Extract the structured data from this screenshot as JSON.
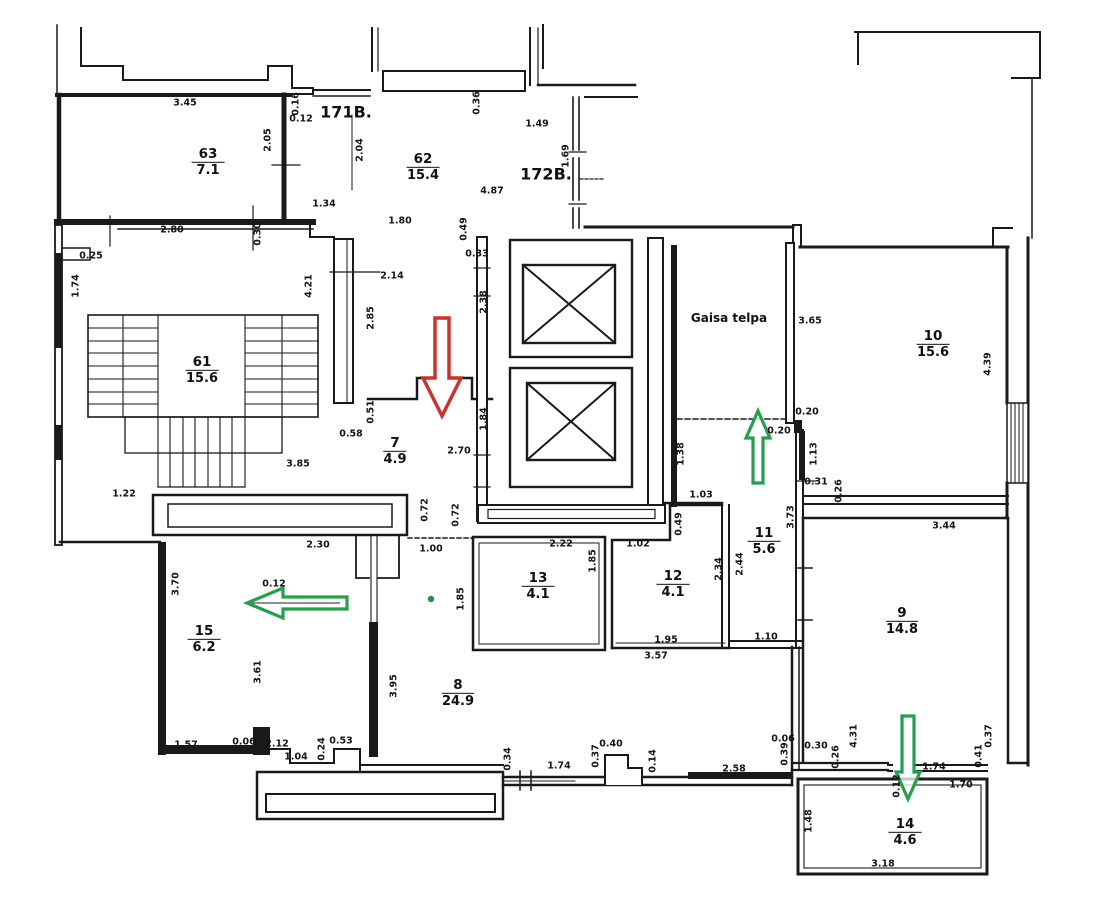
{
  "plan": {
    "colors": {
      "wall": "#1a1a1a",
      "red_arrow": "#d03026",
      "green_arrow": "#22a14b",
      "green_dot": "#2e8b4a"
    },
    "rooms": [
      {
        "number": "63",
        "area": "7.1",
        "x": 208,
        "y": 163
      },
      {
        "number": "62",
        "area": "15.4",
        "x": 423,
        "y": 168
      },
      {
        "number": "61",
        "area": "15.6",
        "x": 202,
        "y": 371
      },
      {
        "number": "7",
        "area": "4.9",
        "x": 395,
        "y": 452
      },
      {
        "number": "10",
        "area": "15.6",
        "x": 933,
        "y": 345
      },
      {
        "number": "11",
        "area": "5.6",
        "x": 764,
        "y": 542
      },
      {
        "number": "13",
        "area": "4.1",
        "x": 538,
        "y": 587
      },
      {
        "number": "12",
        "area": "4.1",
        "x": 673,
        "y": 585
      },
      {
        "number": "9",
        "area": "14.8",
        "x": 902,
        "y": 622
      },
      {
        "number": "15",
        "area": "6.2",
        "x": 204,
        "y": 640
      },
      {
        "number": "8",
        "area": "24.9",
        "x": 458,
        "y": 694
      },
      {
        "number": "14",
        "area": "4.6",
        "x": 905,
        "y": 833
      }
    ],
    "texts": [
      {
        "t": "171B.",
        "x": 346,
        "y": 112,
        "size": 16
      },
      {
        "t": "172B.",
        "x": 546,
        "y": 174,
        "size": 16
      },
      {
        "t": "Gaisa  telpa",
        "x": 729,
        "y": 318,
        "size": 12
      }
    ],
    "dims": [
      {
        "t": "3.45",
        "x": 185,
        "y": 103,
        "r": "h"
      },
      {
        "t": "2.05",
        "x": 268,
        "y": 140,
        "r": "v"
      },
      {
        "t": "0.16",
        "x": 296,
        "y": 104,
        "r": "v"
      },
      {
        "t": "0.12",
        "x": 301,
        "y": 119,
        "r": "h"
      },
      {
        "t": "2.04",
        "x": 360,
        "y": 150,
        "r": "v"
      },
      {
        "t": "0.36",
        "x": 477,
        "y": 103,
        "r": "v"
      },
      {
        "t": "1.49",
        "x": 537,
        "y": 124,
        "r": "h"
      },
      {
        "t": "1.69",
        "x": 566,
        "y": 156,
        "r": "v"
      },
      {
        "t": "4.87",
        "x": 492,
        "y": 191,
        "r": "h"
      },
      {
        "t": "1.80",
        "x": 400,
        "y": 221,
        "r": "h"
      },
      {
        "t": "1.34",
        "x": 324,
        "y": 204,
        "r": "h"
      },
      {
        "t": "2.80",
        "x": 172,
        "y": 230,
        "r": "h"
      },
      {
        "t": "0.30",
        "x": 258,
        "y": 234,
        "r": "v"
      },
      {
        "t": "0.25",
        "x": 91,
        "y": 256,
        "r": "h"
      },
      {
        "t": "1.74",
        "x": 76,
        "y": 286,
        "r": "v"
      },
      {
        "t": "4.21",
        "x": 309,
        "y": 286,
        "r": "v"
      },
      {
        "t": "2.14",
        "x": 392,
        "y": 276,
        "r": "h"
      },
      {
        "t": "2.85",
        "x": 371,
        "y": 318,
        "r": "v"
      },
      {
        "t": "0.49",
        "x": 464,
        "y": 229,
        "r": "v"
      },
      {
        "t": "0.33",
        "x": 477,
        "y": 254,
        "r": "h"
      },
      {
        "t": "2.38",
        "x": 484,
        "y": 302,
        "r": "v"
      },
      {
        "t": "3.85",
        "x": 298,
        "y": 464,
        "r": "h"
      },
      {
        "t": "1.22",
        "x": 124,
        "y": 494,
        "r": "h"
      },
      {
        "t": "0.51",
        "x": 371,
        "y": 412,
        "r": "v"
      },
      {
        "t": "0.58",
        "x": 351,
        "y": 434,
        "r": "h"
      },
      {
        "t": "1.84",
        "x": 484,
        "y": 419,
        "r": "v"
      },
      {
        "t": "2.70",
        "x": 459,
        "y": 451,
        "r": "h"
      },
      {
        "t": "3.65",
        "x": 810,
        "y": 321,
        "r": "h"
      },
      {
        "t": "0.20",
        "x": 807,
        "y": 412,
        "r": "h"
      },
      {
        "t": "0.20",
        "x": 779,
        "y": 431,
        "r": "h"
      },
      {
        "t": "1.38",
        "x": 681,
        "y": 454,
        "r": "v"
      },
      {
        "t": "1.13",
        "x": 814,
        "y": 454,
        "r": "v"
      },
      {
        "t": "0.31",
        "x": 816,
        "y": 482,
        "r": "h"
      },
      {
        "t": "0.26",
        "x": 839,
        "y": 491,
        "r": "v"
      },
      {
        "t": "1.03",
        "x": 701,
        "y": 495,
        "r": "h"
      },
      {
        "t": "4.39",
        "x": 988,
        "y": 364,
        "r": "v"
      },
      {
        "t": "0.49",
        "x": 679,
        "y": 524,
        "r": "v"
      },
      {
        "t": "1.02",
        "x": 638,
        "y": 544,
        "r": "h"
      },
      {
        "t": "2.34",
        "x": 719,
        "y": 569,
        "r": "v"
      },
      {
        "t": "2.44",
        "x": 740,
        "y": 564,
        "r": "v"
      },
      {
        "t": "3.73",
        "x": 791,
        "y": 517,
        "r": "v"
      },
      {
        "t": "1.95",
        "x": 666,
        "y": 640,
        "r": "h"
      },
      {
        "t": "1.10",
        "x": 766,
        "y": 637,
        "r": "h"
      },
      {
        "t": "3.57",
        "x": 656,
        "y": 656,
        "r": "h"
      },
      {
        "t": "2.22",
        "x": 561,
        "y": 544,
        "r": "h"
      },
      {
        "t": "1.85",
        "x": 593,
        "y": 561,
        "r": "v"
      },
      {
        "t": "1.85",
        "x": 461,
        "y": 599,
        "r": "v"
      },
      {
        "t": "0.72",
        "x": 425,
        "y": 510,
        "r": "v"
      },
      {
        "t": "0.72",
        "x": 456,
        "y": 515,
        "r": "v"
      },
      {
        "t": "1.00",
        "x": 431,
        "y": 549,
        "r": "h"
      },
      {
        "t": "2.30",
        "x": 318,
        "y": 545,
        "r": "h"
      },
      {
        "t": "0.12",
        "x": 274,
        "y": 584,
        "r": "h"
      },
      {
        "t": "3.70",
        "x": 176,
        "y": 584,
        "r": "v"
      },
      {
        "t": "3.61",
        "x": 258,
        "y": 672,
        "r": "v"
      },
      {
        "t": "3.95",
        "x": 394,
        "y": 686,
        "r": "v"
      },
      {
        "t": "1.57",
        "x": 186,
        "y": 745,
        "r": "h"
      },
      {
        "t": "0.06",
        "x": 244,
        "y": 742,
        "r": "h"
      },
      {
        "t": "2.12",
        "x": 277,
        "y": 744,
        "r": "h"
      },
      {
        "t": "1.04",
        "x": 296,
        "y": 757,
        "r": "h"
      },
      {
        "t": "0.24",
        "x": 322,
        "y": 749,
        "r": "v"
      },
      {
        "t": "0.53",
        "x": 341,
        "y": 741,
        "r": "h"
      },
      {
        "t": "0.34",
        "x": 508,
        "y": 759,
        "r": "v"
      },
      {
        "t": "1.74",
        "x": 559,
        "y": 766,
        "r": "h"
      },
      {
        "t": "0.37",
        "x": 596,
        "y": 756,
        "r": "v"
      },
      {
        "t": "0.40",
        "x": 611,
        "y": 744,
        "r": "h"
      },
      {
        "t": "0.14",
        "x": 653,
        "y": 761,
        "r": "v"
      },
      {
        "t": "2.58",
        "x": 734,
        "y": 769,
        "r": "h"
      },
      {
        "t": "0.06",
        "x": 783,
        "y": 739,
        "r": "h"
      },
      {
        "t": "0.39",
        "x": 785,
        "y": 754,
        "r": "v"
      },
      {
        "t": "0.30",
        "x": 816,
        "y": 746,
        "r": "h"
      },
      {
        "t": "0.26",
        "x": 836,
        "y": 757,
        "r": "v"
      },
      {
        "t": "4.31",
        "x": 854,
        "y": 736,
        "r": "v"
      },
      {
        "t": "0.12",
        "x": 897,
        "y": 786,
        "r": "v"
      },
      {
        "t": "1.74",
        "x": 934,
        "y": 767,
        "r": "h"
      },
      {
        "t": "1.70",
        "x": 961,
        "y": 785,
        "r": "h"
      },
      {
        "t": "0.41",
        "x": 979,
        "y": 756,
        "r": "v"
      },
      {
        "t": "0.37",
        "x": 989,
        "y": 736,
        "r": "v"
      },
      {
        "t": "1.48",
        "x": 809,
        "y": 821,
        "r": "v"
      },
      {
        "t": "3.18",
        "x": 883,
        "y": 864,
        "r": "h"
      },
      {
        "t": "3.44",
        "x": 944,
        "y": 526,
        "r": "h"
      }
    ]
  }
}
